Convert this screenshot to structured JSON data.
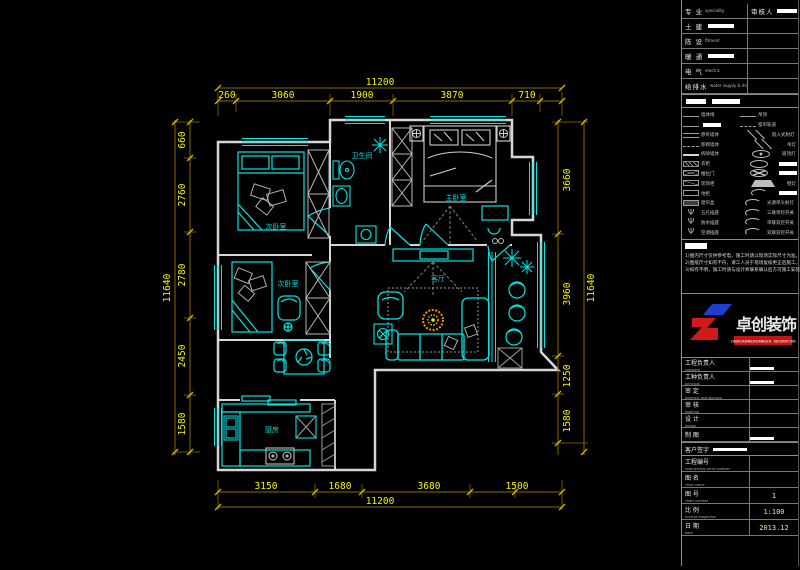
{
  "plan": {
    "rooms": {
      "bedroom2": "次卧室",
      "bathroom": "卫生间",
      "master": "主卧室",
      "living": "客厅",
      "bedroom3": "次卧室",
      "kitchen": "厨房"
    },
    "dims": {
      "top": {
        "overall": "11200",
        "segments": [
          "260",
          "3060",
          "1900",
          "3870",
          "710"
        ]
      },
      "bottom": {
        "overall": "11200",
        "segments": [
          "3150",
          "1680",
          "3680",
          "1500"
        ]
      },
      "left": {
        "overall": "11640",
        "segments": [
          "660",
          "2760",
          "2780",
          "2450",
          "1580"
        ]
      },
      "right": {
        "overall": "11640",
        "segments": [
          "3660",
          "3960",
          "1250",
          "1580"
        ]
      }
    }
  },
  "titleblock": {
    "info_rows": [
      {
        "zh": "专 业",
        "en": "speciality",
        "r_zh": "审核人",
        "r_bar": true
      },
      {
        "zh": "土 建",
        "bar": true
      },
      {
        "zh": "陈 设",
        "en": "fitment"
      },
      {
        "zh": "暖 通",
        "bar": true
      },
      {
        "zh": "电 气",
        "en": "electric"
      },
      {
        "zh": "给排水",
        "en": "water supply & drainage"
      }
    ],
    "legend": {
      "left": [
        {
          "sym": "line",
          "label": "墙体线"
        },
        {
          "sym": "line",
          "label": "",
          "redacted": true
        },
        {
          "sym": "dline",
          "label": "原有墙体"
        },
        {
          "sym": "dash",
          "label": "新砌墙体"
        },
        {
          "sym": "thick",
          "label": "拆除墙体"
        },
        {
          "sym": "hatch",
          "label": "衣柜"
        },
        {
          "sym": "xbox",
          "label": "推拉门"
        },
        {
          "sym": "sbox",
          "label": "装饰柜"
        },
        {
          "sym": "box",
          "label": "地柜"
        },
        {
          "sym": "gbox",
          "label": "窗帘盒"
        },
        {
          "sym": "psi",
          "label": "五孔插座"
        },
        {
          "sym": "psi",
          "label": "防水插座"
        },
        {
          "sym": "psi",
          "label": "空调插座"
        }
      ],
      "right": [
        {
          "sym": "line",
          "label": "吊顶"
        },
        {
          "sym": "dashdot",
          "label": "窗帘轨道"
        },
        {
          "sym": "diamond",
          "label": "嵌入式射灯"
        },
        {
          "sym": "diamond",
          "label": "吊灯"
        },
        {
          "sym": "circdot",
          "label": "吸顶灯"
        },
        {
          "sym": "circle",
          "label": "",
          "redacted": true
        },
        {
          "sym": "circx",
          "label": "",
          "redacted": true
        },
        {
          "sym": "tri",
          "label": "壁灯"
        },
        {
          "sym": "arc",
          "label": "",
          "redacted": true
        },
        {
          "sym": "arc",
          "label": "光源单头射灯"
        },
        {
          "sym": "arc",
          "label": "三联单控开关"
        },
        {
          "sym": "arc",
          "label": "单联双控开关"
        },
        {
          "sym": "arc",
          "label": "双联双控开关"
        }
      ]
    },
    "notes": [
      "1)图内尺寸仅供参考电，施工时请以现场实际尺寸为准。",
      "2)图纸尺寸如有不符，请工人员于现场复核更正后施工。",
      "3)如有不明，施工时请与设计师联系确认后方可施工安装。"
    ],
    "logo": {
      "name": "卓创装饰",
      "sub": "ZHUOCHUANGZHUANGSHI DECORATION"
    },
    "sign_rows": [
      {
        "zh": "工程负责人",
        "en": "compere",
        "bar": true
      },
      {
        "zh": "工种负责人",
        "en": "principal",
        "bar": true
      },
      {
        "zh": "审 定",
        "en": "examine and approve"
      },
      {
        "zh": "审 核",
        "en": "auditing"
      },
      {
        "zh": "设 计",
        "en": "design"
      },
      {
        "zh": "制 图",
        "en": "",
        "bar": true
      }
    ],
    "customer_row": {
      "zh": "客户签字"
    },
    "doc_rows": [
      {
        "zh": "工程编号",
        "en": "engineering serial number",
        "val": ""
      },
      {
        "zh": "图 名",
        "en": "chart name",
        "val": ""
      },
      {
        "zh": "图 号",
        "en": "chart number",
        "val": "1"
      },
      {
        "zh": "比 例",
        "en": "inverse proportion",
        "val": "1:100"
      },
      {
        "zh": "日 期",
        "en": "date",
        "val": "2013.12"
      }
    ]
  },
  "colors": {
    "background": "#000000",
    "wall": "#d6d6d6",
    "furniture_cyan": "#00e6e6",
    "dimension_line": "#8a6d00",
    "dimension_text": "#f5f500",
    "room_label": "#00dede",
    "logo_red": "#d11a1a",
    "logo_blue": "#1a3fd1",
    "rug_flower": "#ff8c00"
  }
}
